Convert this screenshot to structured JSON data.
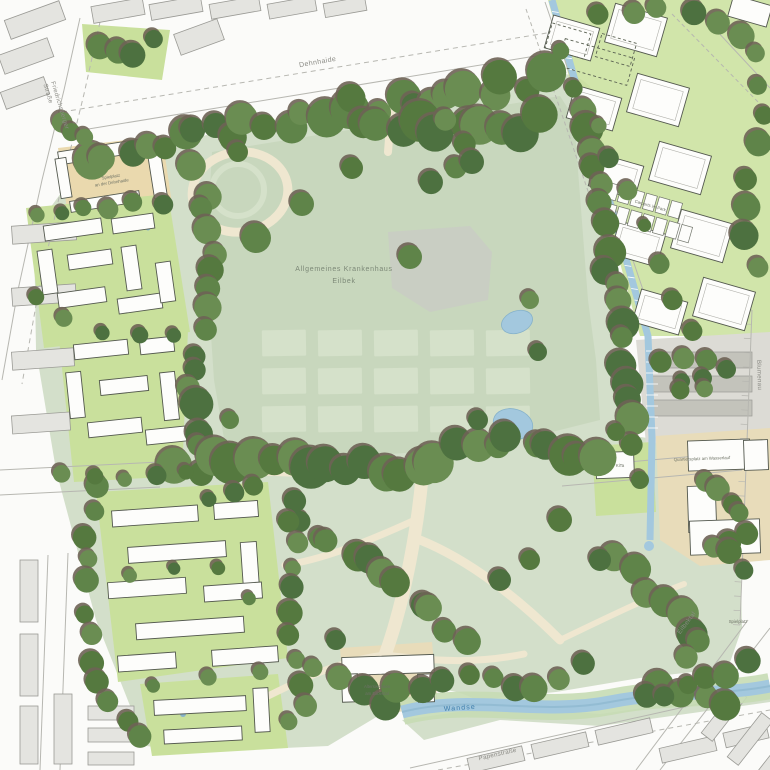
{
  "labels": {
    "hospital_line1": "Allgemeines Krankenhaus",
    "hospital_line2": "Eilbek",
    "street_top": "Dehnhaide",
    "street_left_line1": "Friedrichsberger",
    "street_left_line2": "Straße",
    "street_right": "Blumenau",
    "street_bottom": "Papenstraße",
    "street_southeast": "Eilbektal",
    "river": "Wandse",
    "playground_northwest_line1": "Spielplatz",
    "playground_northwest_line2": "an der Dehnhaide",
    "carports": "Carports im Park",
    "kita": "KiTa",
    "square": "Quartiersplatz am Wasserlauf",
    "playground_southeast": "Spielplatz",
    "senior_housing_line1": "Alterswohnen",
    "senior_housing_line2": "am Eilbektal"
  },
  "palette": {
    "street_white": "#fbfbf9",
    "block_fill": "#e4e4e0",
    "block_stroke": "#9a9a95",
    "park_green": "#d3dfca",
    "lawn_ghost": "#c8d7bd",
    "ghost_footprint": "#d5e1ca",
    "bright_lawn": "#c9e09c",
    "tree_shadow": "#6e6355",
    "path_cream": "#efe7d0",
    "plaza_beige": "#e8dcba",
    "courtyard_beige": "#ead9ae",
    "water_blue": "#a3c8de",
    "water_edge": "#86b2ca",
    "water_bank": "#c6dcb4",
    "building_white": "#fdfdfb",
    "building_stroke": "#53584e",
    "road_line": "#b7b7b1",
    "label_gray": "#8b8b85",
    "label_green": "#6d7265",
    "label_hospital": "#7c8877",
    "label_water": "#3d7dab",
    "gray_plaza": "#c9cdc4",
    "parking_gray": "#dcdbd5",
    "carport_gray": "#c3c3bb",
    "tree_green_1": "#5f8449",
    "tree_green_2": "#55793f",
    "tree_green_3": "#6a8d52",
    "tree_green_4": "#4d7140"
  }
}
